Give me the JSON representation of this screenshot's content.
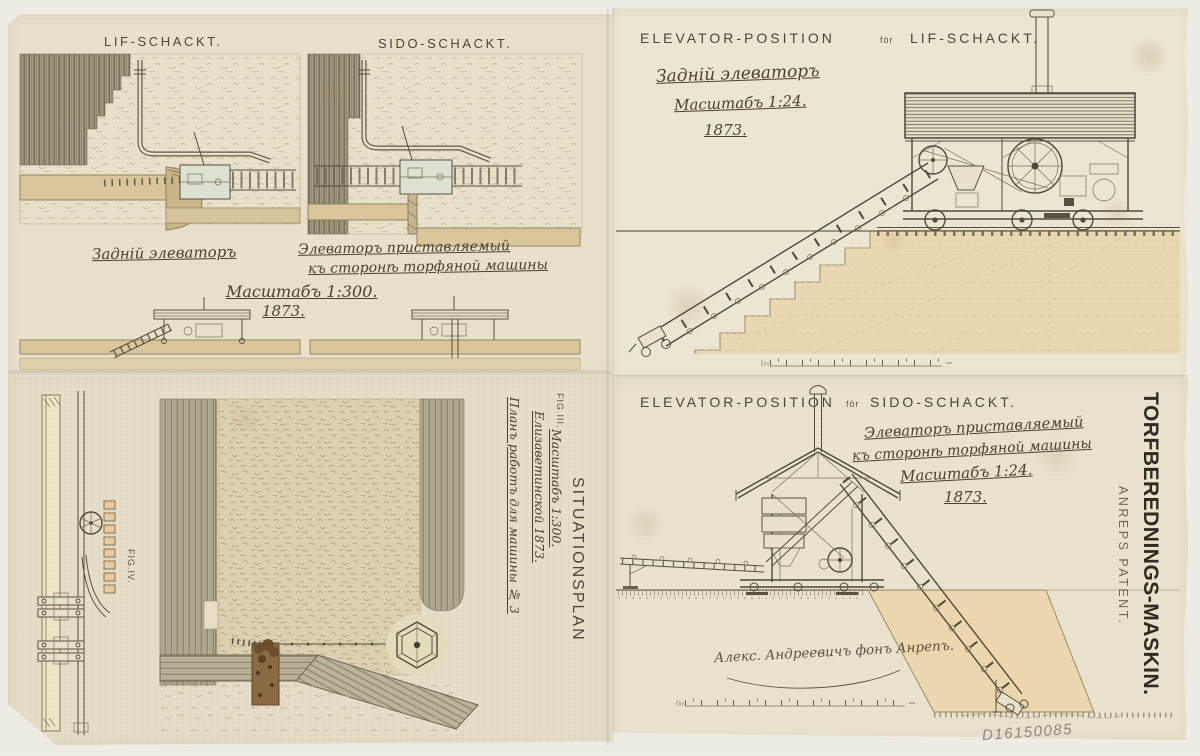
{
  "top_left": {
    "lif_title": "LIF-SCHACKT.",
    "sido_title": "SIDO-SCHACKT.",
    "caption_back": "Задній элеваторъ",
    "caption_side_1": "Элеваторъ приставляемый",
    "caption_side_2": "къ сторонѣ торфяной машины",
    "scale": "Масштабъ 1:300.",
    "year": "1873."
  },
  "top_right": {
    "title": "ELEVATOR-POSITION",
    "for_word": "för",
    "title_shaft": "LIF-SCHACKT.",
    "hw_line1": "Задній элеваторъ",
    "hw_line2": "Масштабъ 1:24.",
    "hw_line3": "1873."
  },
  "bottom_right": {
    "title": "ELEVATOR-POSITION",
    "for_word": "för",
    "title_shaft": "SIDO-SCHACKT.",
    "hw_line1": "Элеваторъ приставляемый",
    "hw_line2": "къ сторонѣ торфяной машины",
    "hw_line3": "Масштабъ 1:24.",
    "hw_line4": "1873.",
    "signature": "Алекс. Андреевичъ фонъ Анрепъ."
  },
  "bottom_left": {
    "fig3": "FIG.III.",
    "fig4": "FIG.IV.",
    "plan_label": "SITUATIONSPLAN",
    "hw_col1": "Планъ работъ для машины № 3",
    "hw_col2": "Елизаветинской 1873.",
    "hw_col3": "Масштабъ 1:300."
  },
  "margin": {
    "title": "TORFBEREDNINGS-MASKIN.",
    "subtitle": "ANREPS PATENT."
  },
  "inventory_number": "D16150085",
  "colors": {
    "paper": "#e9e2cd",
    "backing": "#efede5",
    "ink": "#4b4638",
    "ground_tan": "#ecd7ae",
    "trench_tan": "#dcc79d",
    "pencil": "#8f877b"
  }
}
